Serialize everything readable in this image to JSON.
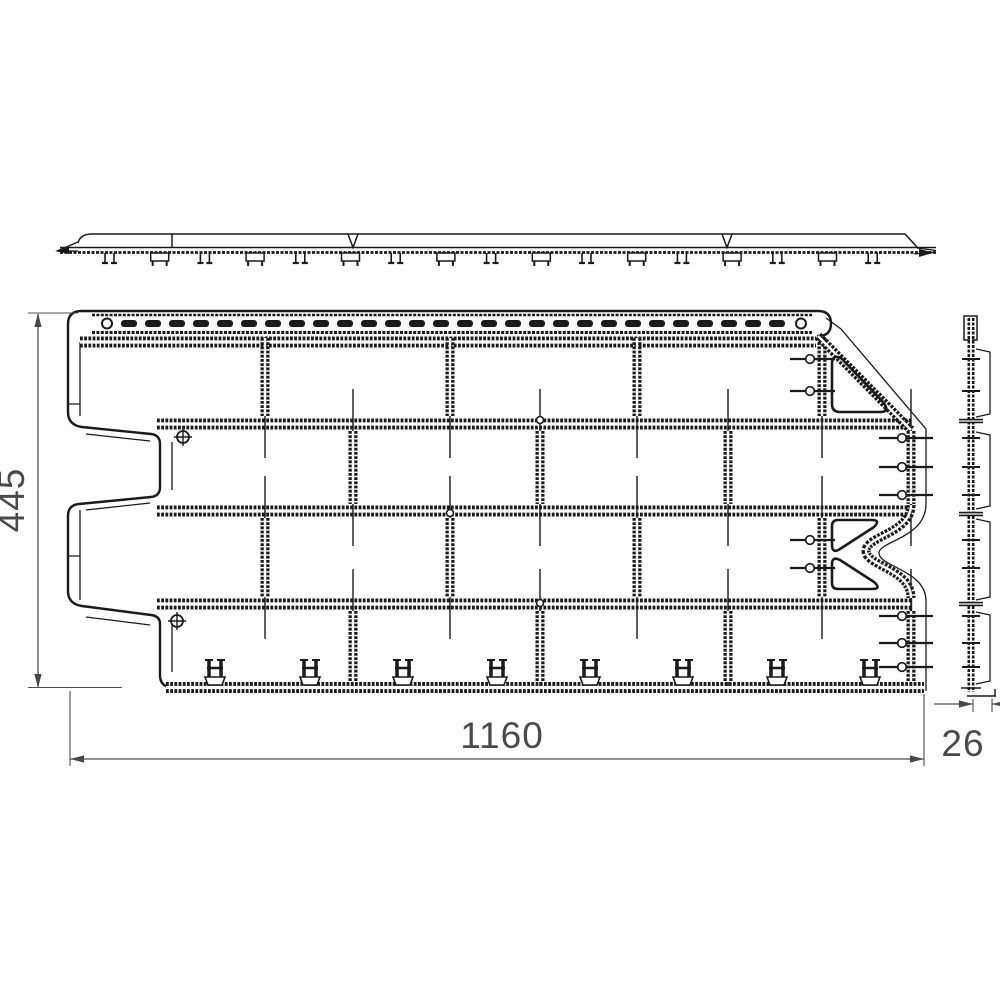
{
  "drawing": {
    "background": "#ffffff",
    "line_color": "#1a1a1a",
    "dim_color": "#4f4f4f",
    "dimensions": {
      "height": "445",
      "width": "1160",
      "depth": "26"
    },
    "figure": {
      "views": [
        "top profile",
        "front",
        "side profile"
      ],
      "brick_rows": 4,
      "nail_slots": 28,
      "bottom_clips": 8,
      "screw_marks": 2,
      "pin_groups": 4
    }
  }
}
